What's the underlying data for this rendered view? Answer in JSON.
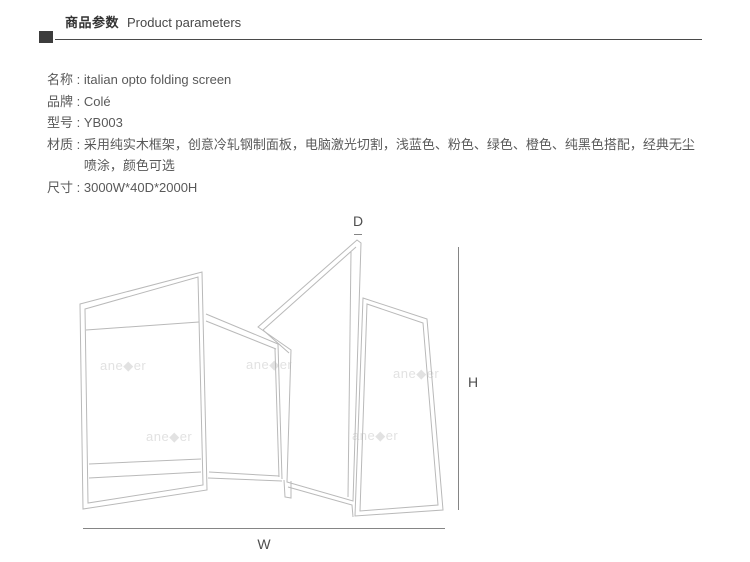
{
  "header": {
    "title_zh": "商品参数",
    "title_en": "Product parameters"
  },
  "separator": " : ",
  "params": [
    {
      "label": "名称",
      "value": "italian opto folding screen"
    },
    {
      "label": "品牌",
      "value": "Colé"
    },
    {
      "label": "型号",
      "value": "YB003"
    },
    {
      "label": "材质",
      "value": "采用纯实木框架，创意冷轧钢制面板，电脑激光切割，浅蓝色、粉色、绿色、橙色、纯黑色搭配，经典无尘喷涂，颜色可选"
    },
    {
      "label": "尺寸",
      "value": "3000W*40D*2000H"
    }
  ],
  "diagram": {
    "depth_label": "D",
    "height_label": "H",
    "width_label": "W",
    "watermark": "ane◆er"
  },
  "colors": {
    "header_square": "#3c3c3c",
    "header_rule": "#4a4a4a",
    "body_text": "#595959",
    "panel_line": "#b9b9b9",
    "dimension_line": "#858585",
    "watermark": "#e2e2e2"
  }
}
